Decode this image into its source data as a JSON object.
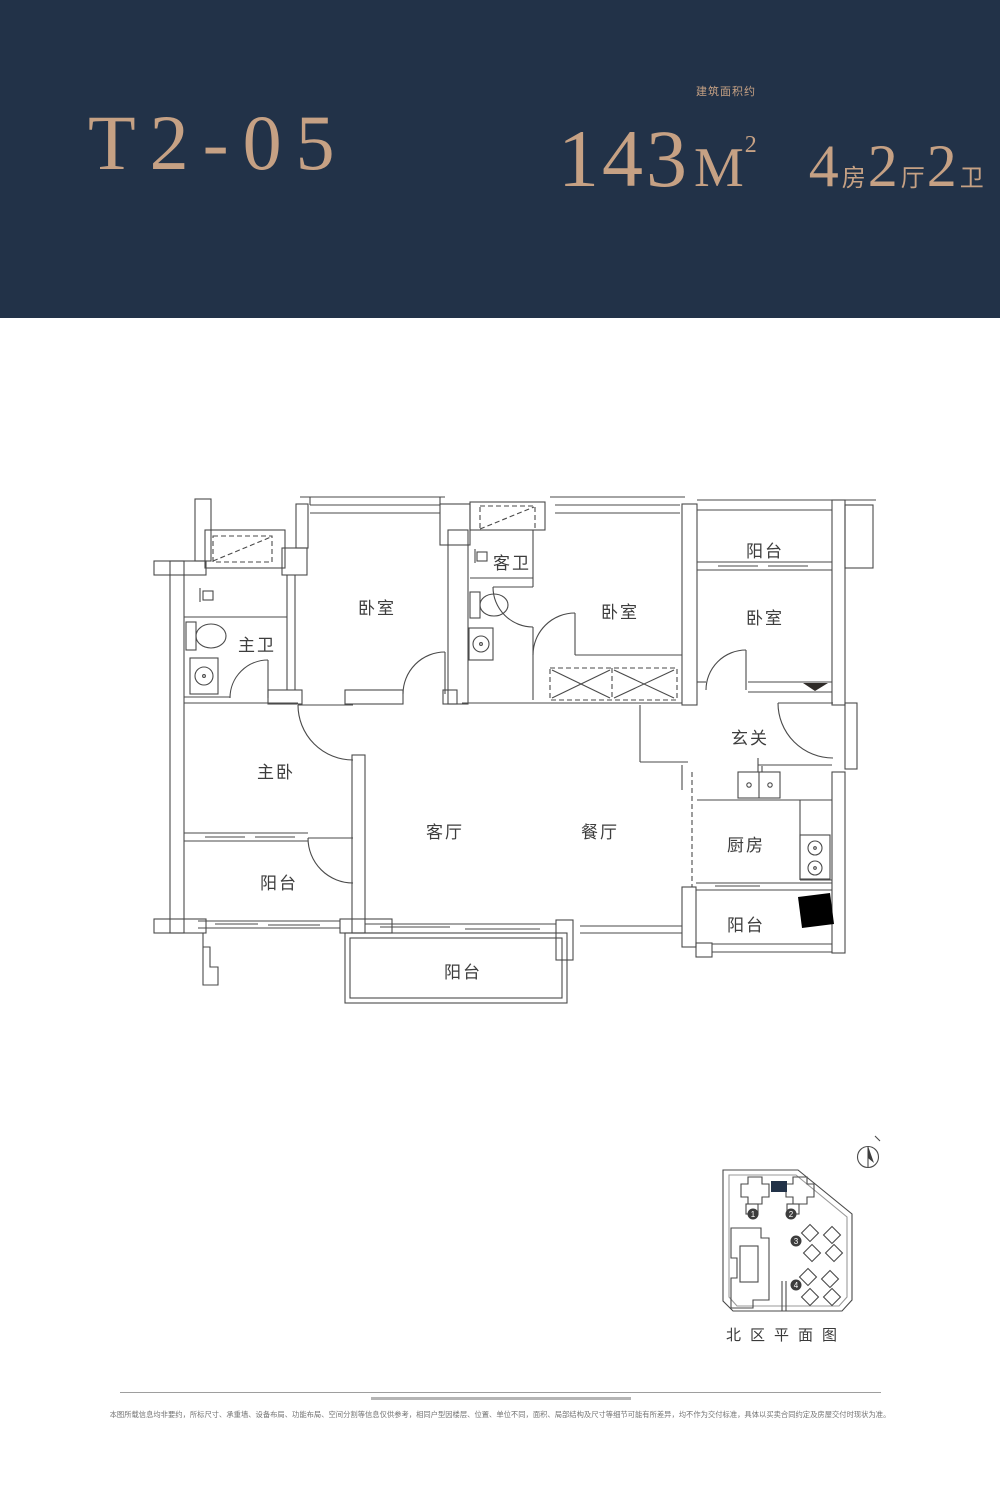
{
  "meta": {
    "accent_color": "#c6a184",
    "header_bg_color": "#223248",
    "wall_color": "#2f2b28",
    "line_color": "#4a4a4a"
  },
  "header": {
    "unit_code": "T2-05",
    "area": {
      "value": "143",
      "unit": "M",
      "sup": "2",
      "note": "建筑面积约"
    },
    "rooms": [
      {
        "num": "4",
        "label": "房"
      },
      {
        "num": "2",
        "label": "厅"
      },
      {
        "num": "2",
        "label": "卫"
      }
    ]
  },
  "floorplan": {
    "labels": [
      {
        "id": "guest-bath",
        "text": "客卫"
      },
      {
        "id": "balcony-top",
        "text": "阳台"
      },
      {
        "id": "bedroom-left",
        "text": "卧室"
      },
      {
        "id": "bedroom-middle",
        "text": "卧室"
      },
      {
        "id": "bedroom-right",
        "text": "卧室"
      },
      {
        "id": "master-bath",
        "text": "主卫"
      },
      {
        "id": "foyer",
        "text": "玄关"
      },
      {
        "id": "master-bedroom",
        "text": "主卧"
      },
      {
        "id": "living-room",
        "text": "客厅"
      },
      {
        "id": "dining-room",
        "text": "餐厅"
      },
      {
        "id": "kitchen",
        "text": "厨房"
      },
      {
        "id": "balcony-master",
        "text": "阳台"
      },
      {
        "id": "balcony-bottom",
        "text": "阳台"
      },
      {
        "id": "balcony-kitchen",
        "text": "阳台"
      }
    ]
  },
  "siteplan": {
    "title": "北区平面图",
    "markers": [
      "1",
      "2",
      "3",
      "4"
    ]
  },
  "footer": {
    "disclaimer": "本图所载信息均非要约，所标尺寸、承重墙、设备布局、功能布局、空间分割等信息仅供参考，相同户型因楼层、位置、单位不同，面积、局部结构及尺寸等细节可能有所差异，均不作为交付标准，具体以买卖合同约定及房屋交付时现状为准。"
  }
}
